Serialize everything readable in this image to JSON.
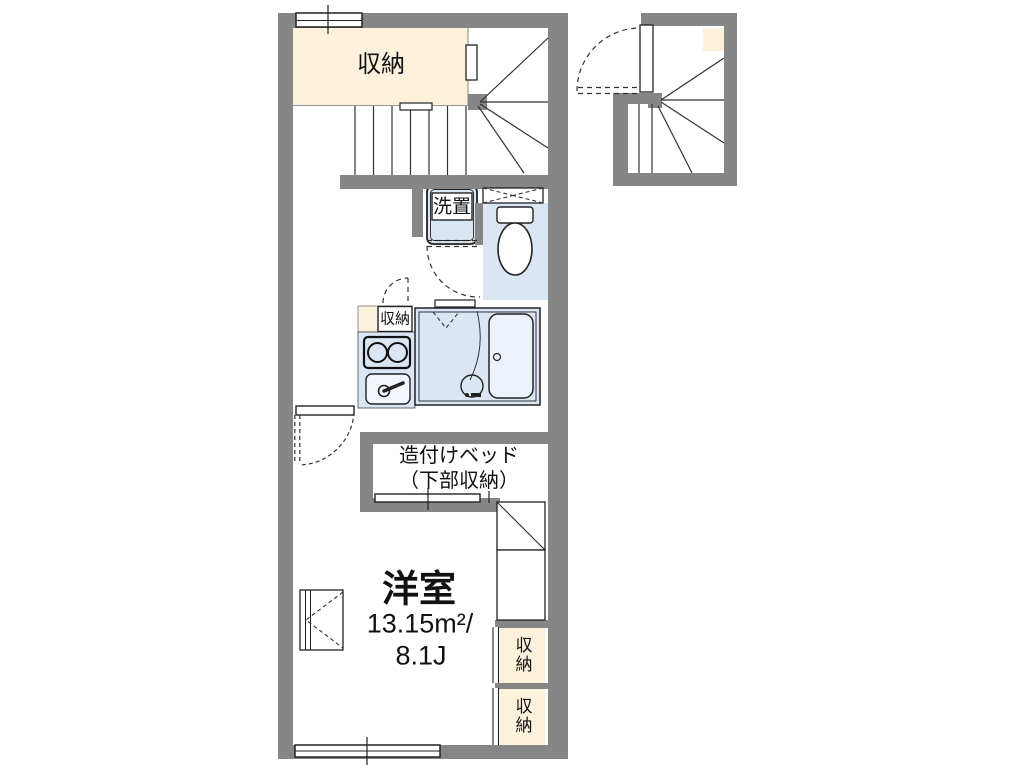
{
  "title": "apartment-floor-plan",
  "colors": {
    "wall": "#868686",
    "cream": "#fcf2dc",
    "wet": "#dbe6f4",
    "tub": "#edf1fa",
    "line": "#222222",
    "white": "#ffffff"
  },
  "labels": {
    "storage_top": "収納",
    "washer": "洗置",
    "storage_small": "収納",
    "bed_line1": "造付けベッド",
    "bed_line2": "（下部収納）",
    "room_name": "洋室",
    "room_area_m2": "13.15m²/",
    "room_area_jo": "8.1J",
    "storage_right_upper": "収納",
    "storage_right_lower": "収納"
  }
}
